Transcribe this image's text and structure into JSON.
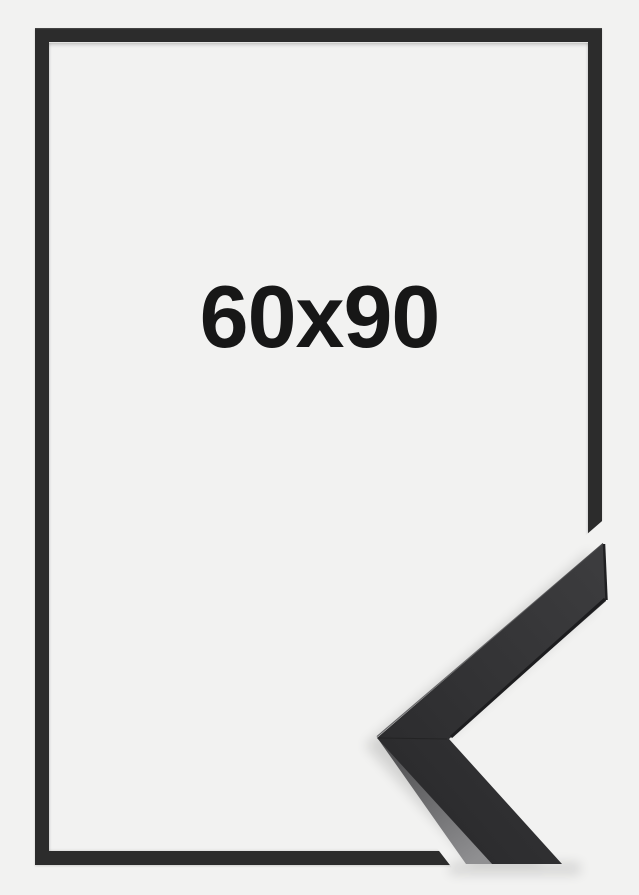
{
  "canvas": {
    "background_color": "#f2f2f1"
  },
  "frame_preview": {
    "size_label": "60x90",
    "label_color": "#171717",
    "frame_color": "#2c2c2c",
    "opening_color": "#f2f2f1"
  },
  "corner_detail": {
    "mask_color": "#f2f2f1",
    "face_color_light": "#3d3d3f",
    "face_color_dark": "#2c2c2e",
    "side_edge_light": "#8f8f91",
    "side_edge_dark": "#4a4a4c",
    "shadow_color": "#000000"
  }
}
